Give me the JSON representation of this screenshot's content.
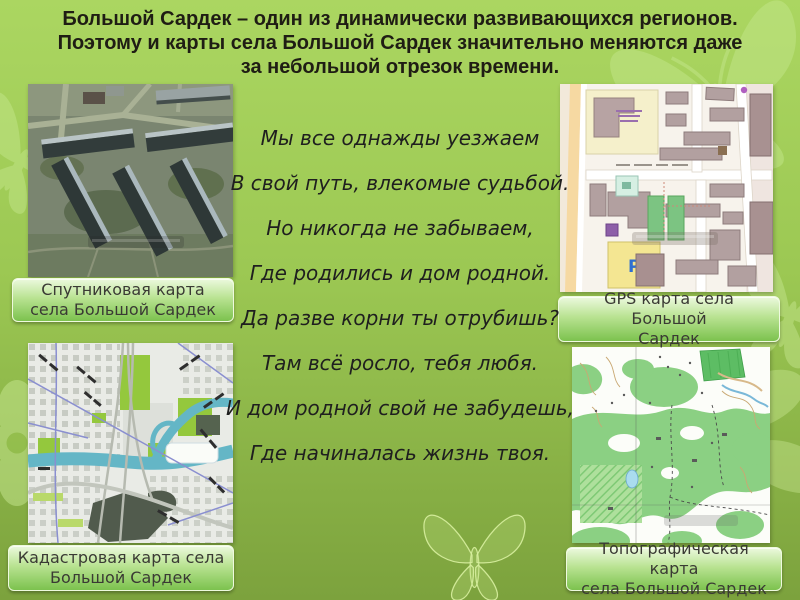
{
  "title": {
    "lines": [
      "Большой Сардек – один из динамически развивающихся регионов.",
      "Поэтому и карты села Большой Сардек значительно меняются даже",
      "за небольшой отрезок времени."
    ]
  },
  "poem": {
    "lines": [
      "Мы все однажды уезжаем",
      "В свой путь, влекомые судьбой.",
      "Но никогда не забываем,",
      "Где родились и дом родной.",
      "Да разве корни ты отрубишь?",
      "Там всё росло, тебя любя.",
      "И дом родной свой не забудешь,",
      "Где начиналась жизнь твоя."
    ]
  },
  "maps": [
    {
      "id": "satellite",
      "caption": "Спутниковая карта села Большой Сардек",
      "caption_lines": [
        "Спутниковая карта",
        "села Большой Сардек"
      ]
    },
    {
      "id": "gps",
      "caption": "GPS карта села Большой Сардек",
      "caption_lines": [
        "GPS карта села Большой",
        "Сардек"
      ],
      "parking_label": "P"
    },
    {
      "id": "cadastral",
      "caption": "Кадастровая карта села Большой Сардек",
      "caption_lines": [
        "Кадастровая карта села",
        "Большой Сардек"
      ]
    },
    {
      "id": "topographic",
      "caption": "Топографическая карта села Большой Сардек",
      "caption_lines": [
        "Топографическая карта",
        "села Большой Сардек"
      ]
    }
  ],
  "colors": {
    "background_top": "#abd661",
    "background_bottom": "#7ca23d",
    "caption_gradient_top": "#ecf9de",
    "caption_gradient_bottom": "#7cc24e",
    "title_text": "#1f1d14",
    "poem_text": "#1f1f1f"
  }
}
